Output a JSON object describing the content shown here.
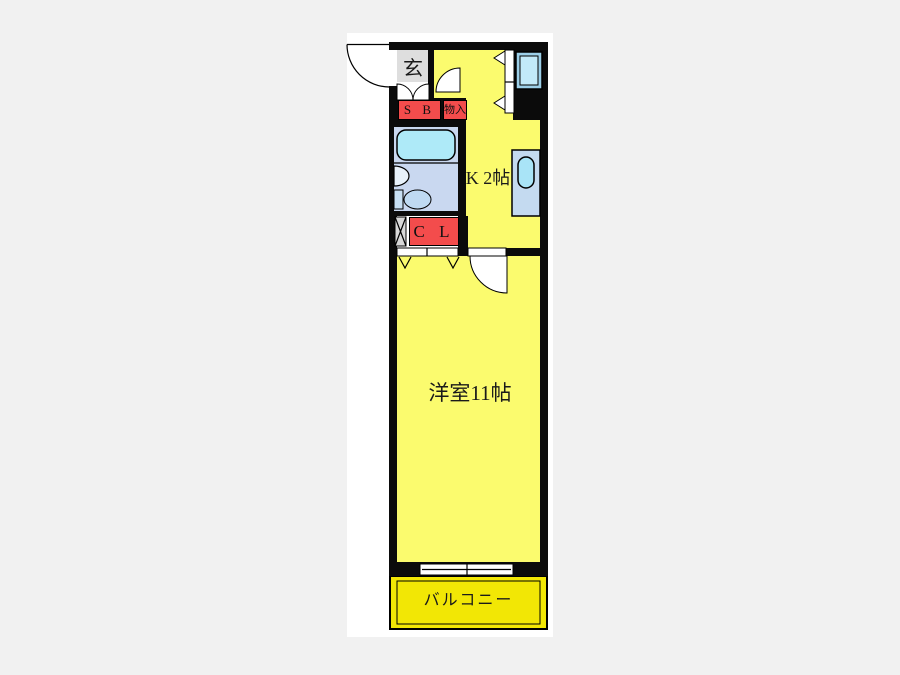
{
  "page": {
    "background": "#f1f1f1",
    "image_background": "#ffffff"
  },
  "floorplan": {
    "colors": {
      "page_bg": "#f1f1f1",
      "image_bg": "#ffffff",
      "wall": "#0b0b0b",
      "room_yellow": "#fbfb6e",
      "balcony_yellow": "#f2e705",
      "entrance_gray": "#dedede",
      "label_red": "#f34c4c",
      "bath_floor": "#c9d8f0",
      "tub_blue": "#aeeaf8",
      "counter_blue": "#c4daf0",
      "sink_blue": "#a9e4f7",
      "window_blue": "#c2eaf9",
      "window_frame_blue": "#9ccfe8",
      "hatch_gray": "#d8d8d8",
      "label_text": "#1a1a1a"
    },
    "labels": {
      "entrance": "玄",
      "shoe_box": "S B",
      "storage": "物入",
      "closet": "C L",
      "kitchen": "K 2帖",
      "main_room": "洋室11帖",
      "balcony": "バルコニー"
    }
  }
}
